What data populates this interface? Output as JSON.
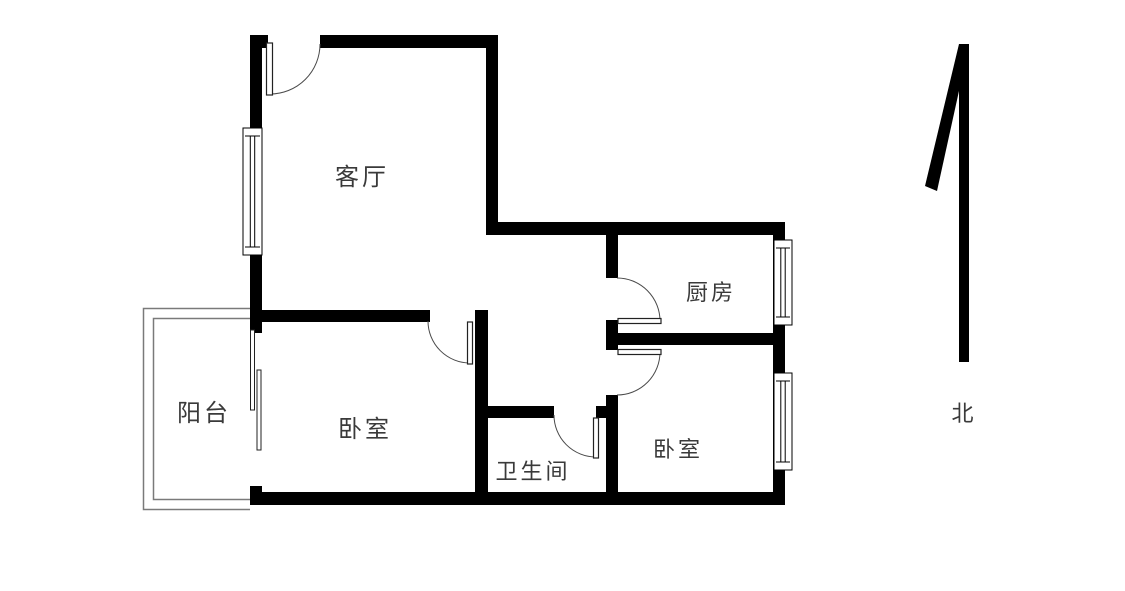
{
  "meta": {
    "type": "apartment-floor-plan",
    "description": "2-bedroom apartment floor plan with north arrow"
  },
  "colors": {
    "background": "#ffffff",
    "wall": "#000000",
    "thin_line": "#7a7a7a",
    "door_arc": "#4a4a4a",
    "leaf_stroke": "#222222",
    "text": "#3a3a3a"
  },
  "rooms": [
    {
      "id": "living-room",
      "label": "客厅",
      "cx": 362,
      "cy": 177,
      "font": 24
    },
    {
      "id": "kitchen",
      "label": "厨房",
      "cx": 711,
      "cy": 294,
      "font": 22
    },
    {
      "id": "balcony",
      "label": "阳台",
      "cx": 204,
      "cy": 413,
      "font": 24
    },
    {
      "id": "bedroom-west",
      "label": "卧室",
      "cx": 365,
      "cy": 429,
      "font": 24
    },
    {
      "id": "bathroom",
      "label": "卫生间",
      "cx": 533,
      "cy": 473,
      "font": 22
    },
    {
      "id": "bedroom-east",
      "label": "卧室",
      "cx": 678,
      "cy": 451,
      "font": 22
    }
  ],
  "compass": {
    "label": "北",
    "cx": 964,
    "cy": 415,
    "font": 22,
    "bar": {
      "x": 959,
      "y": 44,
      "w": 10,
      "h": 318
    },
    "flick_points": "925,186 937,191 968,50 959,44"
  },
  "plan": {
    "walls": [
      {
        "name": "wall-top-left",
        "x": 250,
        "y": 35,
        "w": 18,
        "h": 13
      },
      {
        "name": "wall-top-right",
        "x": 320,
        "y": 35,
        "w": 178,
        "h": 13
      },
      {
        "name": "wall-west-exterior",
        "x": 250,
        "y": 35,
        "w": 12,
        "h": 298
      },
      {
        "name": "wall-livingroom-east",
        "x": 486,
        "y": 35,
        "w": 12,
        "h": 200
      },
      {
        "name": "wall-kitchen-north",
        "x": 486,
        "y": 222,
        "w": 299,
        "h": 13
      },
      {
        "name": "wall-east-kitchen",
        "x": 773,
        "y": 222,
        "w": 12,
        "h": 123
      },
      {
        "name": "wall-kitchen-south",
        "x": 608,
        "y": 333,
        "w": 177,
        "h": 12
      },
      {
        "name": "wall-east-bedroom",
        "x": 773,
        "y": 333,
        "w": 12,
        "h": 172
      },
      {
        "name": "wall-south",
        "x": 250,
        "y": 492,
        "w": 535,
        "h": 13
      },
      {
        "name": "wall-bedroom-west-north",
        "x": 250,
        "y": 310,
        "w": 180,
        "h": 12
      },
      {
        "name": "wall-mid-vertical",
        "x": 475,
        "y": 310,
        "w": 13,
        "h": 195
      },
      {
        "name": "wall-bathroom-north",
        "x": 488,
        "y": 406,
        "w": 66,
        "h": 12
      },
      {
        "name": "wall-bathroom-north-stub",
        "x": 596,
        "y": 406,
        "w": 22,
        "h": 12
      },
      {
        "name": "wall-hall-east-upper",
        "x": 606,
        "y": 235,
        "w": 12,
        "h": 43
      },
      {
        "name": "wall-hall-east-mid",
        "x": 606,
        "y": 320,
        "w": 12,
        "h": 30
      },
      {
        "name": "wall-hall-east-lower",
        "x": 606,
        "y": 395,
        "w": 12,
        "h": 110
      },
      {
        "name": "wall-balcony-stub",
        "x": 250,
        "y": 486,
        "w": 12,
        "h": 19
      }
    ],
    "windows": [
      {
        "name": "window-living-room",
        "x": 243,
        "y": 128,
        "w": 19,
        "h": 127
      },
      {
        "name": "window-kitchen",
        "x": 774,
        "y": 240,
        "w": 18,
        "h": 85
      },
      {
        "name": "window-bedroom-east",
        "x": 774,
        "y": 373,
        "w": 18,
        "h": 97
      }
    ],
    "doors": [
      {
        "name": "door-entry",
        "leaf": {
          "x": 266.5,
          "y": 43,
          "w": 6,
          "h": 52
        },
        "arc": {
          "sx": 320,
          "sy": 44,
          "r": 50,
          "ex": 270,
          "ey": 94,
          "sweep": 1
        }
      },
      {
        "name": "door-bedroom-west",
        "leaf": {
          "x": 467.5,
          "y": 322,
          "w": 5,
          "h": 42
        },
        "arc": {
          "sx": 428,
          "sy": 321,
          "r": 42,
          "ex": 470,
          "ey": 363,
          "sweep": 0
        }
      },
      {
        "name": "door-kitchen",
        "leaf": {
          "x": 618,
          "y": 318.5,
          "w": 43,
          "h": 5
        },
        "arc": {
          "sx": 617,
          "sy": 278,
          "r": 43,
          "ex": 660,
          "ey": 321,
          "sweep": 1
        }
      },
      {
        "name": "door-bedroom-east",
        "leaf": {
          "x": 618,
          "y": 349.5,
          "w": 43,
          "h": 5
        },
        "arc": {
          "sx": 660,
          "sy": 352,
          "r": 43,
          "ex": 617,
          "ey": 395,
          "sweep": 1
        }
      },
      {
        "name": "door-bathroom",
        "leaf": {
          "x": 593.5,
          "y": 418,
          "w": 5,
          "h": 40
        },
        "arc": {
          "sx": 554,
          "sy": 415,
          "r": 42,
          "ex": 596,
          "ey": 457,
          "sweep": 0
        }
      }
    ],
    "balcony": {
      "outer": "M 250 308.5 L 143.5 308.5 L 143.5 509.5 L 250 509.5",
      "inner": "M 250 318.5 L 153.5 318.5 L 153.5 499.5 L 250 499.5"
    },
    "sliding_door_panels": [
      {
        "name": "sliding-panel-a",
        "x": 250.5,
        "y": 330,
        "w": 4,
        "h": 80
      },
      {
        "name": "sliding-panel-b",
        "x": 257,
        "y": 370,
        "w": 4,
        "h": 80
      }
    ]
  }
}
